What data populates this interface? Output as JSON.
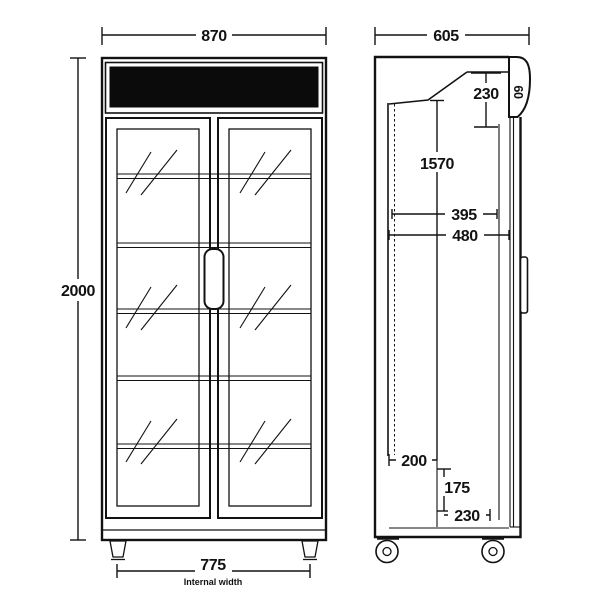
{
  "diagram": {
    "subject": "upright two-door glass display fridge, dimensioned line drawing",
    "colors": {
      "line": "#121212",
      "background": "#ffffff",
      "header_panel_fill": "#0b0b0b"
    },
    "front_view": {
      "width_mm": "870",
      "height_mm": "2000",
      "internal_width_mm": "775",
      "internal_width_label": "Internal width"
    },
    "side_view": {
      "depth_mm": "605",
      "canopy_height_mm": "230",
      "canopy_depth_mm": "60",
      "glass_door_height_mm": "1570",
      "shelf_depth_mm": "395",
      "internal_depth_mm": "480",
      "base_back_depth_mm": "200",
      "base_height_mm": "175",
      "base_front_depth_mm": "230"
    }
  }
}
